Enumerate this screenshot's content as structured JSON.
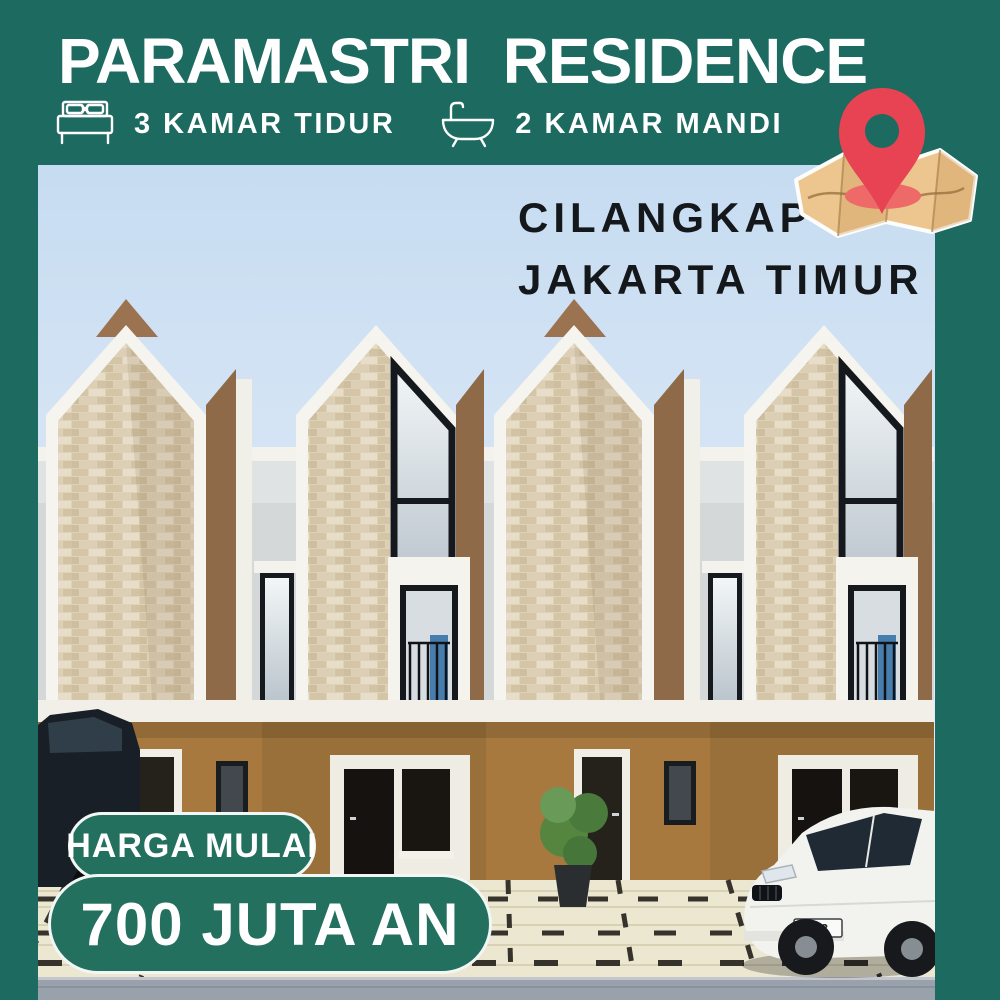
{
  "theme": {
    "background_green": "#1c6a60",
    "badge_green": "#23705f",
    "pin_red": "#e84352",
    "map_tan": "#edc58e",
    "sky_blue": "#cfe2f2",
    "location_text_color": "#15181b",
    "title_color": "#ffffff"
  },
  "header": {
    "title": "PARAMASTRI RESIDENCE",
    "features": [
      {
        "icon": "bed-icon",
        "label": "3 KAMAR TIDUR"
      },
      {
        "icon": "bathtub-icon",
        "label": "2 KAMAR MANDI"
      }
    ]
  },
  "location": {
    "line1": "CILANGKAP",
    "line2": "JAKARTA TIMUR"
  },
  "price": {
    "label": "HARGA MULAI",
    "value": "700 JUTA AN"
  },
  "vehicle": {
    "license_plate": "B 3"
  }
}
